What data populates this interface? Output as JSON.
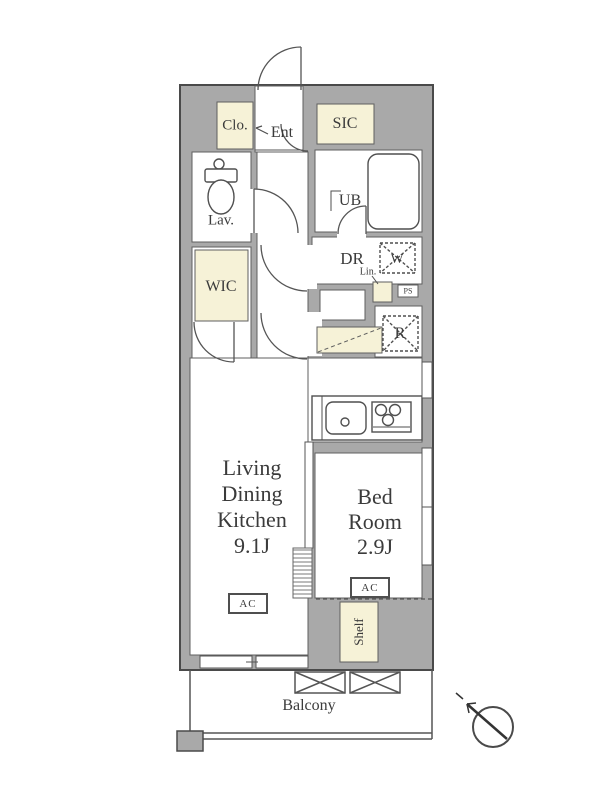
{
  "colors": {
    "wall_fill": "#a9a9a9",
    "wall_outline": "#4a4a4a",
    "line": "#565656",
    "room_fill": "#ffffff",
    "closet_fill": "#f6f2d7",
    "text": "#3b3b3b"
  },
  "plan": {
    "labels": {
      "clo": "Clo.",
      "ent": "Ent",
      "sic": "SIC",
      "lav": "Lav.",
      "ub": "UB",
      "dr": "DR",
      "lin": "Lin.",
      "w": "W",
      "ps": "PS",
      "wic": "WIC",
      "r": "R",
      "ac": "AC",
      "shelf": "Shelf",
      "balcony": "Balcony"
    },
    "ldk": {
      "lines": [
        "Living",
        "Dining",
        "Kitchen",
        "9.1J"
      ]
    },
    "bedroom": {
      "lines": [
        "Bed",
        "Room",
        "2.9J"
      ]
    }
  }
}
